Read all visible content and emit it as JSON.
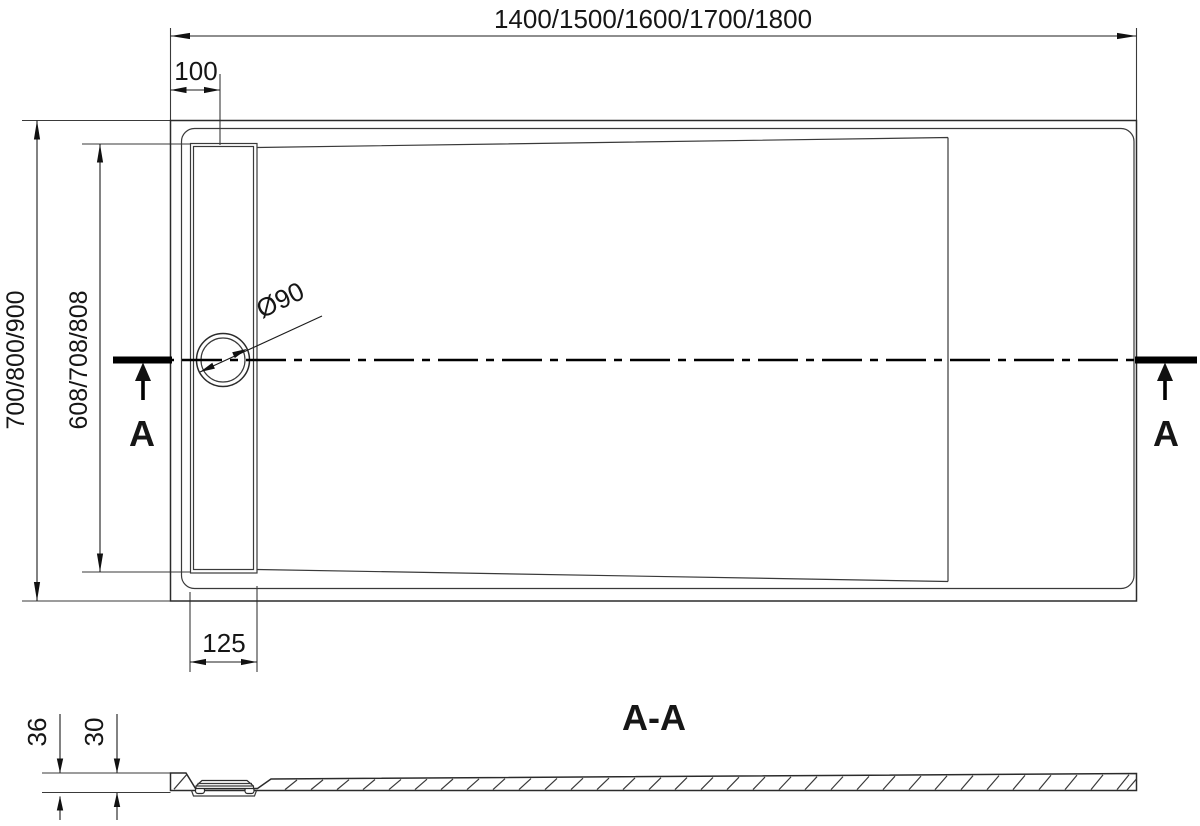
{
  "drawing": {
    "plan": {
      "dim_length_options": "1400/1500/1600/1700/1800",
      "dim_drain_offset": "100",
      "dim_width_options": "700/800/900",
      "dim_inner_width_options": "608/708/808",
      "dim_drain_diameter": "Ø90",
      "dim_drain_strip_width": "125",
      "section_marker_left": "A",
      "section_marker_right": "A"
    },
    "section": {
      "label": "A-A",
      "dim_total_height": "36",
      "dim_body_height": "30"
    }
  }
}
